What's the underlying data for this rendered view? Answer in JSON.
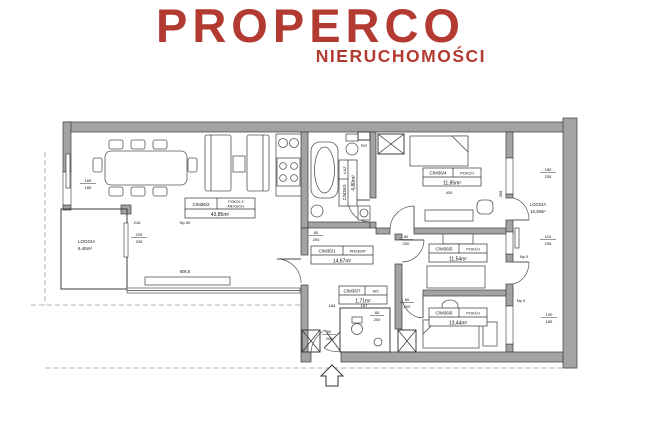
{
  "brand": {
    "name": "PROPERCO",
    "tagline": "NIERUCHOMOŚCI",
    "color": "#b23a30"
  },
  "plan": {
    "rooms": [
      {
        "id": "C/M36/2",
        "name": "POKÓJ Z",
        "name2": "AN.KUCH.",
        "area": "43,85m²"
      },
      {
        "id": "C/M36/1",
        "name": "PRZEDP.",
        "area": "14,67m²"
      },
      {
        "id": "C/M36/3",
        "name": "ŁAZ.",
        "area": "4,80m²"
      },
      {
        "id": "C/M36/4",
        "name": "POKÓJ",
        "area": "11,85m²"
      },
      {
        "id": "C/M36/5",
        "name": "POKÓJ",
        "area": "11,54m²"
      },
      {
        "id": "C/M36/6",
        "name": "POKÓJ",
        "area": "13,44m²"
      },
      {
        "id": "C/M36/7",
        "name": "WC",
        "area": "1,71m²"
      }
    ],
    "loggia_left": {
      "name": "LOGGIA",
      "area": "6,46m²"
    },
    "loggia_right": {
      "name": "LOGGIA",
      "area": "10,38m²"
    },
    "windows": {
      "w165": {
        "top": "165",
        "bottom": "185"
      },
      "w225": {
        "top": "225",
        "bottom": "235"
      },
      "w180": {
        "top": "180",
        "bottom": "235"
      },
      "w110": {
        "top": "110",
        "bottom": "235"
      },
      "w190": {
        "top": "190",
        "bottom": "185"
      }
    },
    "doors": {
      "d80": {
        "top": "80",
        "bottom": "200"
      },
      "d90": {
        "top": "90",
        "bottom": "200"
      }
    },
    "dims": {
      "living_width": "608,5",
      "n216": "216",
      "n430": "430",
      "n358": "358",
      "n184": "184",
      "n167": "167"
    },
    "levels": {
      "np50": "Np 50",
      "np0": "Np 0"
    },
    "misc": {
      "rg": "RG"
    }
  }
}
